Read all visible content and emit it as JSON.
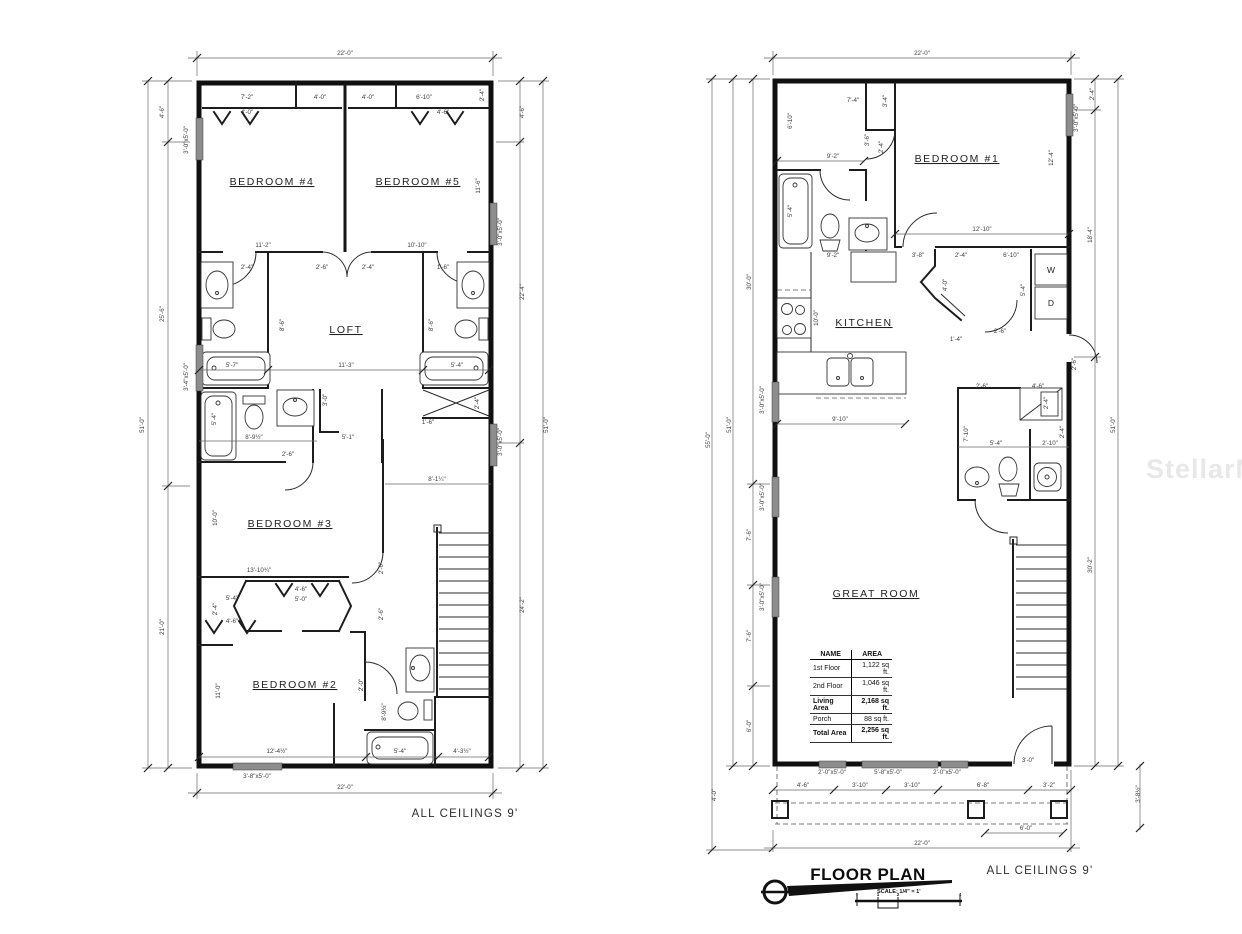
{
  "watermark": "StellarMLS",
  "notes": {
    "second_floor_note": "ALL CEILINGS 9'",
    "first_floor_note": "ALL CEILINGS 9'"
  },
  "title_block": {
    "title": "FLOOR PLAN",
    "scale_label": "SCALE: 1/4\" = 1'",
    "ticks": [
      {
        "t": "0",
        "x": 857,
        "y": 896
      },
      {
        "t": "1",
        "x": 878,
        "y": 896
      },
      {
        "t": "2",
        "x": 898,
        "y": 896
      },
      {
        "t": "4",
        "x": 960,
        "y": 896
      }
    ]
  },
  "area_table": {
    "headers": [
      "NAME",
      "AREA"
    ],
    "rows": [
      [
        "1st Floor",
        "1,122 sq ft."
      ],
      [
        "2nd Floor",
        "1,046 sq ft."
      ],
      [
        "Living Area",
        "2,168 sq ft."
      ],
      [
        "Porch",
        "88 sq ft."
      ],
      [
        "Total Area",
        "2,256 sq ft."
      ]
    ],
    "bold_rows": [
      2,
      4
    ]
  },
  "second_floor": {
    "rooms": [
      {
        "t": "BEDROOM #4",
        "x": 272,
        "y": 185
      },
      {
        "t": "BEDROOM #5",
        "x": 418,
        "y": 185
      },
      {
        "t": "LOFT",
        "x": 346,
        "y": 333
      },
      {
        "t": "BEDROOM #3",
        "x": 290,
        "y": 527
      },
      {
        "t": "BEDROOM #2",
        "x": 295,
        "y": 688
      }
    ],
    "dims": [
      {
        "t": "22'-0\"",
        "x": 345,
        "y": 55
      },
      {
        "t": "7'-2\"",
        "x": 247,
        "y": 99
      },
      {
        "t": "4'-0\"",
        "x": 320,
        "y": 99
      },
      {
        "t": "4'-0\"",
        "x": 368,
        "y": 99
      },
      {
        "t": "6'-10\"",
        "x": 424,
        "y": 99
      },
      {
        "t": "2'-4\"",
        "x": 484,
        "y": 95,
        "r": 1
      },
      {
        "t": "4'-0\"",
        "x": 247,
        "y": 114
      },
      {
        "t": "4'-6\"",
        "x": 443,
        "y": 114
      },
      {
        "t": "51'-0\"",
        "x": 144,
        "y": 425,
        "r": 1
      },
      {
        "t": "4'-6\"",
        "x": 164,
        "y": 112,
        "r": 1
      },
      {
        "t": "25'-6\"",
        "x": 164,
        "y": 314,
        "r": 1
      },
      {
        "t": "21'-0\"",
        "x": 164,
        "y": 627,
        "r": 1
      },
      {
        "t": "3'-0\"x5'-0\"",
        "x": 188,
        "y": 140,
        "r": 1
      },
      {
        "t": "3'-4\"x5'-0\"",
        "x": 188,
        "y": 377,
        "r": 1
      },
      {
        "t": "51'-0\"",
        "x": 548,
        "y": 425,
        "r": 1
      },
      {
        "t": "4'-6\"",
        "x": 524,
        "y": 112,
        "r": 1
      },
      {
        "t": "22'-4\"",
        "x": 524,
        "y": 292,
        "r": 1
      },
      {
        "t": "24'-2\"",
        "x": 524,
        "y": 605,
        "r": 1
      },
      {
        "t": "3'-0\"x5'-0\"",
        "x": 502,
        "y": 232,
        "r": 1
      },
      {
        "t": "3'-0\"x5'-0\"",
        "x": 502,
        "y": 442,
        "r": 1
      },
      {
        "t": "11'-6\"",
        "x": 480,
        "y": 186,
        "r": 1
      },
      {
        "t": "11'-2\"",
        "x": 263,
        "y": 247
      },
      {
        "t": "10'-10\"",
        "x": 417,
        "y": 247
      },
      {
        "t": "2'-4\"",
        "x": 247,
        "y": 269
      },
      {
        "t": "2'-6\"",
        "x": 322,
        "y": 269
      },
      {
        "t": "2'-4\"",
        "x": 368,
        "y": 269
      },
      {
        "t": "1'-6\"",
        "x": 443,
        "y": 269
      },
      {
        "t": "8'-6\"",
        "x": 284,
        "y": 325,
        "r": 1
      },
      {
        "t": "8'-6\"",
        "x": 433,
        "y": 325,
        "r": 1
      },
      {
        "t": "5'-7\"",
        "x": 232,
        "y": 367
      },
      {
        "t": "11'-3\"",
        "x": 346,
        "y": 367
      },
      {
        "t": "5'-4\"",
        "x": 457,
        "y": 367
      },
      {
        "t": "3'-0\"",
        "x": 327,
        "y": 400,
        "r": 1
      },
      {
        "t": "5'-4\"",
        "x": 216,
        "y": 419,
        "r": 1
      },
      {
        "t": "2'-4\"",
        "x": 479,
        "y": 403,
        "r": 1
      },
      {
        "t": "1'-6\"",
        "x": 428,
        "y": 424
      },
      {
        "t": "8'-9½\"",
        "x": 254,
        "y": 439
      },
      {
        "t": "5'-1\"",
        "x": 348,
        "y": 439
      },
      {
        "t": "2'-6\"",
        "x": 288,
        "y": 456
      },
      {
        "t": "8'-1¼\"",
        "x": 437,
        "y": 481
      },
      {
        "t": "10'-0\"",
        "x": 217,
        "y": 518,
        "r": 1
      },
      {
        "t": "13'-10¾\"",
        "x": 259,
        "y": 572
      },
      {
        "t": "2'-6\"",
        "x": 383,
        "y": 568,
        "r": 1
      },
      {
        "t": "4'-6\"",
        "x": 301,
        "y": 591
      },
      {
        "t": "5'-0\"",
        "x": 301,
        "y": 601
      },
      {
        "t": "5'-4\"",
        "x": 232,
        "y": 600
      },
      {
        "t": "2'-4\"",
        "x": 217,
        "y": 609,
        "r": 1
      },
      {
        "t": "4'-6\"",
        "x": 232,
        "y": 623
      },
      {
        "t": "2'-6\"",
        "x": 383,
        "y": 614,
        "r": 1
      },
      {
        "t": "11'-0\"",
        "x": 220,
        "y": 691,
        "r": 1
      },
      {
        "t": "2'-0\"",
        "x": 363,
        "y": 685,
        "r": 1
      },
      {
        "t": "8'-9½\"",
        "x": 386,
        "y": 712,
        "r": 1
      },
      {
        "t": "12'-4½\"",
        "x": 277,
        "y": 753
      },
      {
        "t": "5'-4\"",
        "x": 400,
        "y": 753
      },
      {
        "t": "4'-3½\"",
        "x": 462,
        "y": 753
      },
      {
        "t": "3'-8\"x5'-0\"",
        "x": 257,
        "y": 778
      },
      {
        "t": "22'-0\"",
        "x": 345,
        "y": 789
      }
    ]
  },
  "first_floor": {
    "rooms": [
      {
        "t": "BEDROOM #1",
        "x": 957,
        "y": 162
      },
      {
        "t": "KITCHEN",
        "x": 864,
        "y": 326
      },
      {
        "t": "GREAT ROOM",
        "x": 876,
        "y": 597
      }
    ],
    "marks": [
      {
        "t": "W",
        "x": 1051,
        "y": 273
      },
      {
        "t": "D",
        "x": 1051,
        "y": 306
      }
    ],
    "dims": [
      {
        "t": "22'-0\"",
        "x": 922,
        "y": 55
      },
      {
        "t": "7'-4\"",
        "x": 853,
        "y": 102
      },
      {
        "t": "3'-4\"",
        "x": 887,
        "y": 101,
        "r": 1
      },
      {
        "t": "6'-10\"",
        "x": 792,
        "y": 121,
        "r": 1
      },
      {
        "t": "9'-2\"",
        "x": 833,
        "y": 158
      },
      {
        "t": "3'-6\"",
        "x": 869,
        "y": 140,
        "r": 1
      },
      {
        "t": "2'-4\"",
        "x": 883,
        "y": 147,
        "r": 1
      },
      {
        "t": "12'-4\"",
        "x": 1053,
        "y": 158,
        "r": 1
      },
      {
        "t": "5'-4\"",
        "x": 792,
        "y": 211,
        "r": 1
      },
      {
        "t": "12'-10\"",
        "x": 982,
        "y": 231
      },
      {
        "t": "2'-4\"",
        "x": 1094,
        "y": 94,
        "r": 1
      },
      {
        "t": "3'-0\"x5'-0\"",
        "x": 1078,
        "y": 118,
        "r": 1
      },
      {
        "t": "18'-4\"",
        "x": 1092,
        "y": 235,
        "r": 1
      },
      {
        "t": "30'-2\"",
        "x": 1092,
        "y": 565,
        "r": 1
      },
      {
        "t": "51'-0\"",
        "x": 1115,
        "y": 425,
        "r": 1
      },
      {
        "t": "9'-2\"",
        "x": 833,
        "y": 257
      },
      {
        "t": "3'-8\"",
        "x": 918,
        "y": 257
      },
      {
        "t": "2'-4\"",
        "x": 961,
        "y": 257
      },
      {
        "t": "6'-10\"",
        "x": 1011,
        "y": 257
      },
      {
        "t": "4'-0\"",
        "x": 947,
        "y": 285,
        "r": 1
      },
      {
        "t": "10'-0\"",
        "x": 818,
        "y": 318,
        "r": 1
      },
      {
        "t": "5'-4\"",
        "x": 1025,
        "y": 290,
        "r": 1
      },
      {
        "t": "1'-4\"",
        "x": 956,
        "y": 341
      },
      {
        "t": "2'-6\"",
        "x": 1000,
        "y": 333
      },
      {
        "t": "2'-6\"",
        "x": 1076,
        "y": 364,
        "r": 1
      },
      {
        "t": "9'-10\"",
        "x": 840,
        "y": 421
      },
      {
        "t": "2'-6\"",
        "x": 982,
        "y": 388
      },
      {
        "t": "4'-6\"",
        "x": 1038,
        "y": 388
      },
      {
        "t": "2'-4\"",
        "x": 1048,
        "y": 403,
        "r": 1
      },
      {
        "t": "7'-10\"",
        "x": 968,
        "y": 434,
        "r": 1
      },
      {
        "t": "5'-4\"",
        "x": 996,
        "y": 445
      },
      {
        "t": "2'-10\"",
        "x": 1050,
        "y": 445
      },
      {
        "t": "2'-4\"",
        "x": 1064,
        "y": 432,
        "r": 1
      },
      {
        "t": "55'-0\"",
        "x": 710,
        "y": 440,
        "r": 1
      },
      {
        "t": "51'-0\"",
        "x": 731,
        "y": 425,
        "r": 1
      },
      {
        "t": "30'-0\"",
        "x": 751,
        "y": 282,
        "r": 1
      },
      {
        "t": "7'-6\"",
        "x": 751,
        "y": 535,
        "r": 1
      },
      {
        "t": "7'-6\"",
        "x": 751,
        "y": 636,
        "r": 1
      },
      {
        "t": "6'-0\"",
        "x": 751,
        "y": 726,
        "r": 1
      },
      {
        "t": "3'-0\"x5'-0\"",
        "x": 764,
        "y": 400,
        "r": 1
      },
      {
        "t": "3'-0\"x5'-0\"",
        "x": 764,
        "y": 497,
        "r": 1
      },
      {
        "t": "3'-0\"x5'-0\"",
        "x": 764,
        "y": 597,
        "r": 1
      },
      {
        "t": "4'-0\"",
        "x": 716,
        "y": 795,
        "r": 1
      },
      {
        "t": "3'-8½\"",
        "x": 1140,
        "y": 794,
        "r": 1
      },
      {
        "t": "2'-0\"x5'-0\"",
        "x": 832,
        "y": 774
      },
      {
        "t": "5'-8\"x5'-0\"",
        "x": 888,
        "y": 774
      },
      {
        "t": "2'-0\"x5'-0\"",
        "x": 947,
        "y": 774
      },
      {
        "t": "3'-0\"",
        "x": 1028,
        "y": 762
      },
      {
        "t": "4'-6\"",
        "x": 803,
        "y": 787
      },
      {
        "t": "3'-10\"",
        "x": 860,
        "y": 787
      },
      {
        "t": "3'-10\"",
        "x": 912,
        "y": 787
      },
      {
        "t": "6'-8\"",
        "x": 983,
        "y": 787
      },
      {
        "t": "3'-2\"",
        "x": 1049,
        "y": 787
      },
      {
        "t": "6'-0\"",
        "x": 1026,
        "y": 830
      },
      {
        "t": "22'-0\"",
        "x": 922,
        "y": 845
      }
    ]
  }
}
